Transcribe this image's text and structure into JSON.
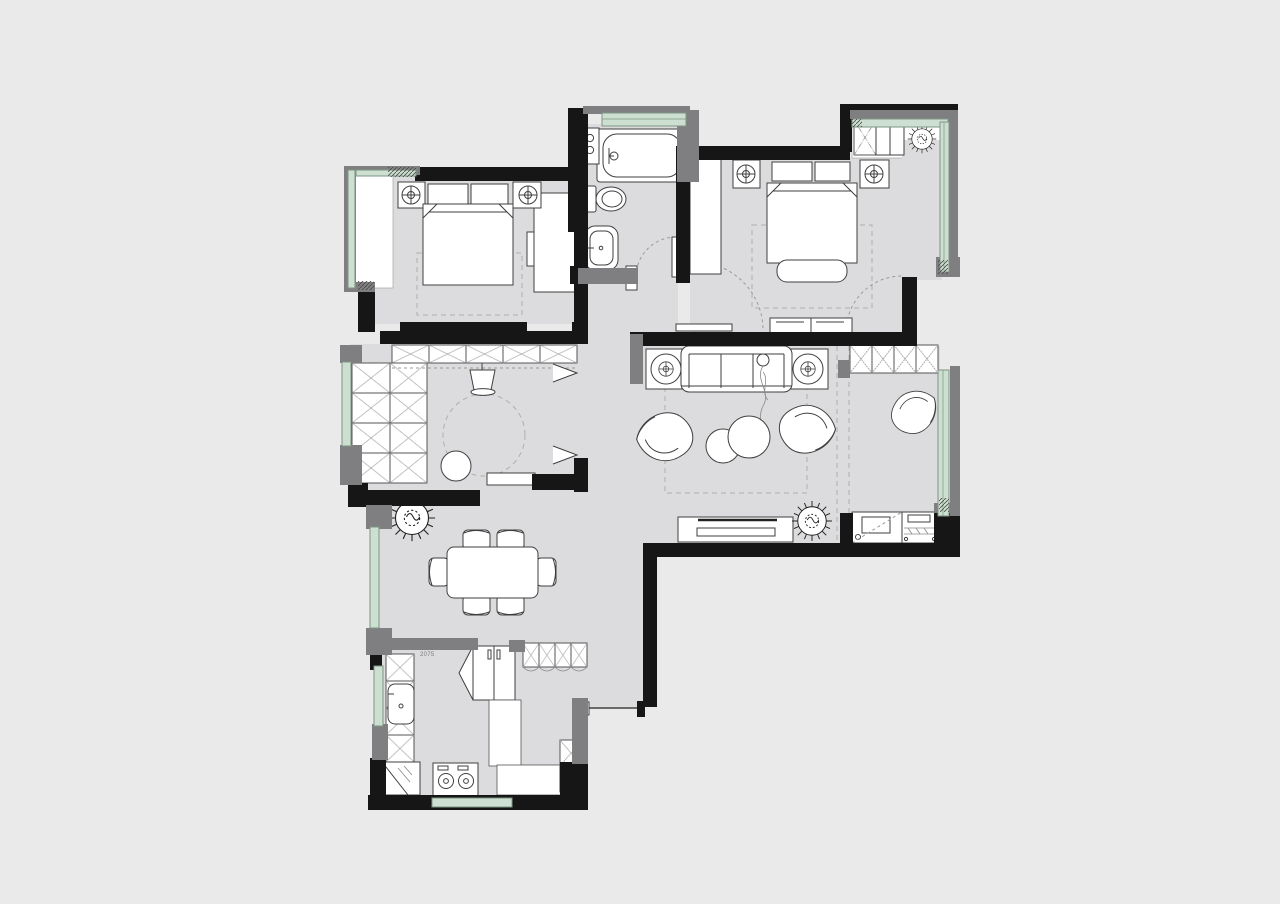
{
  "page": {
    "type": "architectural-floor-plan",
    "description": "furnished apartment floor plan drawing"
  },
  "canvas": {
    "width": 1280,
    "height": 904
  },
  "palette": {
    "page_background": "#eaeaea",
    "floor": "#dcdcde",
    "balcony_floor": "#ffffff",
    "wall": "#161616",
    "wall_secondary": "#7f7f82",
    "window_glass": "#cddfd0",
    "window_frame": "#7d9483",
    "furniture_line": "#3f3f3f",
    "dashed_guide": "#aeaeae"
  },
  "annotations": {
    "kitchen_door_width_label": "2075"
  },
  "rooms": [
    {
      "id": "bedroom-1",
      "name": "Bedroom",
      "furniture": [
        "bay-window",
        "double-bed",
        "pillows",
        "nightstand-with-lamp",
        "wardrobe-rail",
        "rug",
        "door-swing"
      ]
    },
    {
      "id": "bathroom",
      "name": "Bathroom",
      "furniture": [
        "bathtub",
        "vanity-cabinet",
        "toilet",
        "wash-basin",
        "door-swing",
        "window"
      ]
    },
    {
      "id": "master-bedroom",
      "name": "Master Bedroom",
      "furniture": [
        "wardrobe-rail",
        "double-bed",
        "pillows",
        "nightstand-with-lamp",
        "foot-bench",
        "rug",
        "dresser",
        "balcony-door-swing"
      ]
    },
    {
      "id": "balcony",
      "name": "Balcony",
      "furniture": [
        "storage-cell",
        "cabinet",
        "plant",
        "window"
      ]
    },
    {
      "id": "walk-in-closet",
      "name": "Walk-in Closet",
      "furniture": [
        "cabinet-row",
        "cabinet-grid",
        "desk-chair",
        "round-stool",
        "low-bench",
        "round-rug",
        "folding-door"
      ]
    },
    {
      "id": "living-room",
      "name": "Living Room",
      "furniture": [
        "sofa",
        "person-figure",
        "side-table-with-lamp",
        "armchair",
        "coffee-table",
        "rug",
        "tv-console",
        "plant",
        "sliding-partition-track"
      ]
    },
    {
      "id": "study-nook",
      "name": "Study Nook",
      "furniture": [
        "storage-cells",
        "lounge-chair",
        "desk-with-equipment",
        "window"
      ]
    },
    {
      "id": "dining-room",
      "name": "Dining Room",
      "furniture": [
        "dining-table",
        "dining-chairs-x6",
        "plant",
        "window"
      ]
    },
    {
      "id": "kitchen",
      "name": "Kitchen",
      "furniture": [
        "counter-cells",
        "sink",
        "corner-counter",
        "stove",
        "sliding-door",
        "window"
      ]
    },
    {
      "id": "storage-room",
      "name": "Pantry / Laundry",
      "furniture": [
        "refrigerator",
        "overhead-cabinets",
        "hanging-rail",
        "utility-cabinet"
      ]
    },
    {
      "id": "entry",
      "name": "Entry",
      "furniture": [
        "door-threshold",
        "shoe-cabinet"
      ]
    }
  ]
}
